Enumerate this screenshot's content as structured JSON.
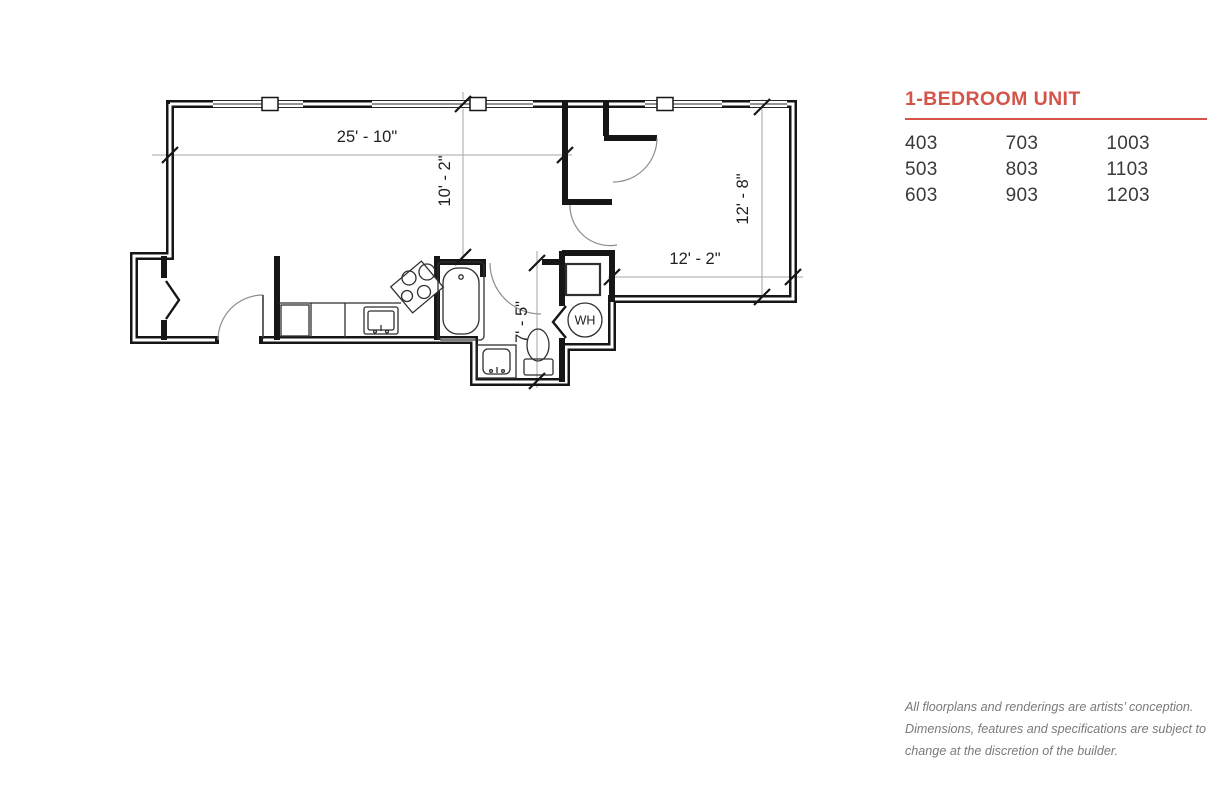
{
  "panel": {
    "title": "1-BEDROOM UNIT",
    "accent_color": "#d4544a",
    "unit_columns": [
      [
        "403",
        "503",
        "603"
      ],
      [
        "703",
        "803",
        "903"
      ],
      [
        "1003",
        "1103",
        "1203"
      ]
    ],
    "disclaimer": [
      "All floorplans and renderings are artists’ conception.",
      "Dimensions, features and specifications are subject to",
      "change at the discretion of the builder."
    ]
  },
  "floorplan": {
    "dim_living_width": "25' - 10\"",
    "dim_living_depth": "10' - 2\"",
    "dim_bedroom_depth": "12' - 8\"",
    "dim_bedroom_width": "12' - 2\"",
    "dim_bath_depth": "7' - 5\"",
    "water_heater_label": "WH",
    "wall_color": "#161616"
  }
}
